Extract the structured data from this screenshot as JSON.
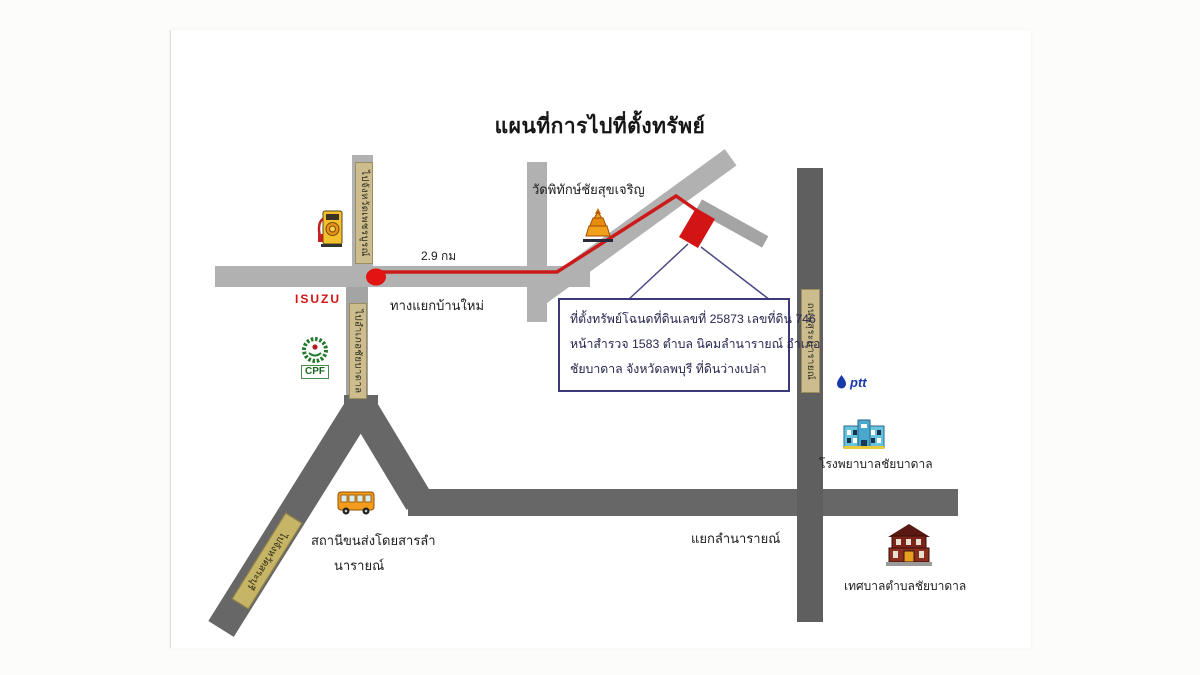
{
  "title": "แผนที่การไปที่ตั้งทรัพย์",
  "road_plates": {
    "to_phetchabun": "ไปจังหวัดเพชรบูรณ์",
    "to_chaibadan": "ไปอำเภอชัยบาดาล",
    "suranarai_road": "ถนนสุระนารายณ์",
    "to_saraburi": "ไปจังหวัดสระบุรี"
  },
  "route": {
    "distance": "2.9 กม",
    "start_junction": "ทางแยกบ้านใหม่"
  },
  "places": {
    "temple": "วัดพิทักษ์ชัยสุขเจริญ",
    "lamnarai_junction": "แยกลำนารายณ์",
    "hospital": "โรงพยาบาลชัยบาดาล",
    "municipality": "เทศบาลตำบลชัยบาดาล",
    "bus_terminal_line1": "สถานีขนส่งโดยสารลำ",
    "bus_terminal_line2": "นารายณ์"
  },
  "logos": {
    "isuzu": "ISUZU",
    "cpf": "CPF",
    "ptt": "ptt"
  },
  "info_box": {
    "line1": "ที่ตั้งทรัพย์โฉนดที่ดินเลขที่ 25873 เลขที่ดิน 746",
    "line2": "หน้าสำรวจ 1583 ตำบล นิคมลำนารายณ์ อำเภอ",
    "line3": "ชัยบาดาล จังหวัดลพบุรี ที่ดินว่างเปล่า"
  },
  "colors": {
    "route_red": "#cc1a1a",
    "marker_red": "#d31414",
    "road_light": "#b1b1b1",
    "road_dark": "#676767",
    "plate_tan": "#cdbd8e",
    "info_border": "#3a3a7a",
    "callout_navy": "#4a4a85"
  }
}
